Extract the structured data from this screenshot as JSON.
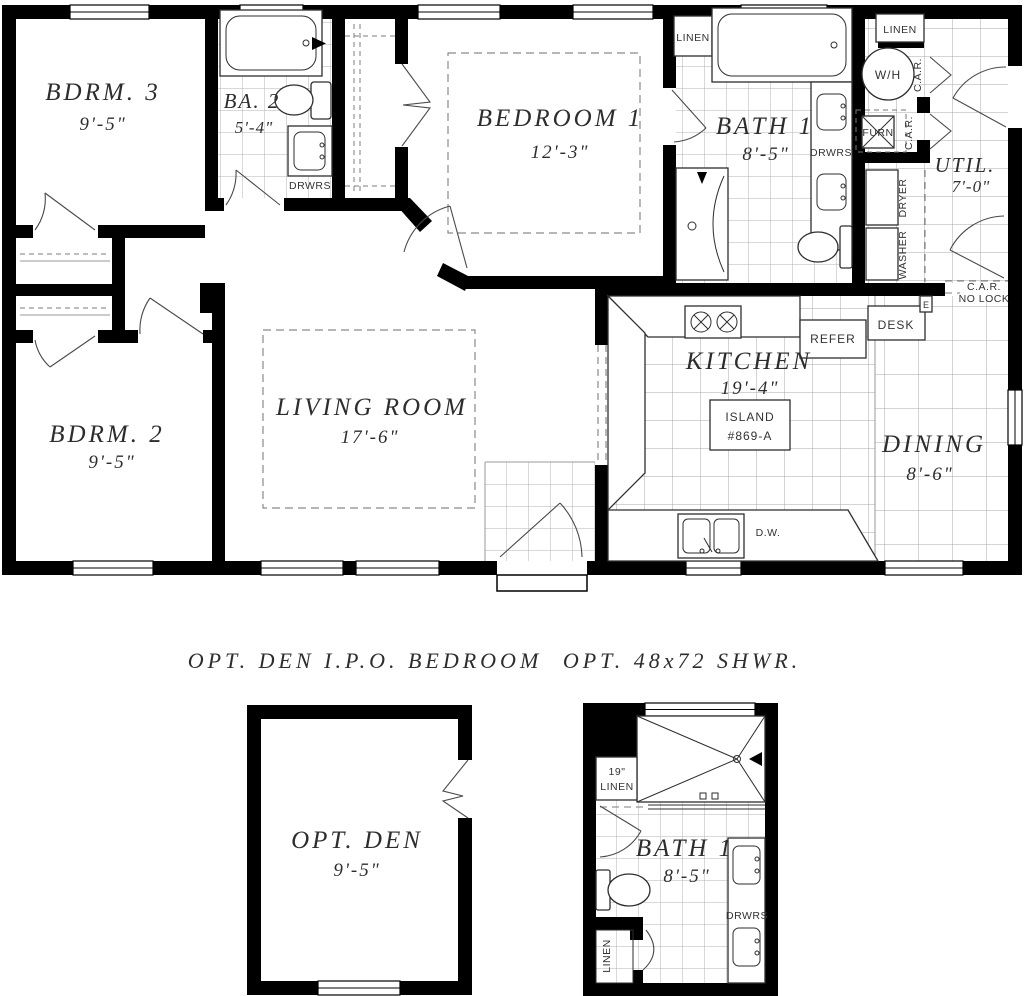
{
  "main": {
    "rooms": {
      "bdrm3": {
        "name": "BDRM. 3",
        "dim": "9'-5\""
      },
      "ba2": {
        "name": "BA. 2",
        "dim": "5'-4\""
      },
      "bedroom1": {
        "name": "BEDROOM 1",
        "dim": "12'-3\""
      },
      "bath1": {
        "name": "BATH 1",
        "dim": "8'-5\""
      },
      "util": {
        "name": "UTIL.",
        "dim": "7'-0\""
      },
      "bdrm2": {
        "name": "BDRM. 2",
        "dim": "9'-5\""
      },
      "living": {
        "name": "LIVING ROOM",
        "dim": "17'-6\""
      },
      "kitchen": {
        "name": "KITCHEN",
        "dim": "19'-4\""
      },
      "dining": {
        "name": "DINING",
        "dim": "8'-6\""
      }
    },
    "labels": {
      "linen": "LINEN",
      "drwrs": "DRWRS",
      "wh": "W/H",
      "furn": "FURN",
      "car": "C.A.R.",
      "nolock_line1": "C.A.R.",
      "nolock_line2": "NO LOCK",
      "washer": "WASHER",
      "dryer": "DRYER",
      "desk": "DESK",
      "refer": "REFER",
      "island_line1": "ISLAND",
      "island_line2": "#869-A",
      "dw": "D.W.",
      "epanel": "E"
    }
  },
  "options": {
    "den": {
      "title": "OPT. DEN I.P.O. BEDROOM",
      "room": "OPT. DEN",
      "dim": "9'-5\""
    },
    "shower": {
      "title": "OPT. 48x72 SHWR.",
      "room": "BATH 1",
      "dim": "8'-5\"",
      "linen_size": "19\"",
      "linen": "LINEN",
      "drwrs": "DRWRS"
    }
  },
  "colors": {
    "wall": "#000000",
    "tile_line": "#adadad",
    "text": "#2d2d2d"
  }
}
